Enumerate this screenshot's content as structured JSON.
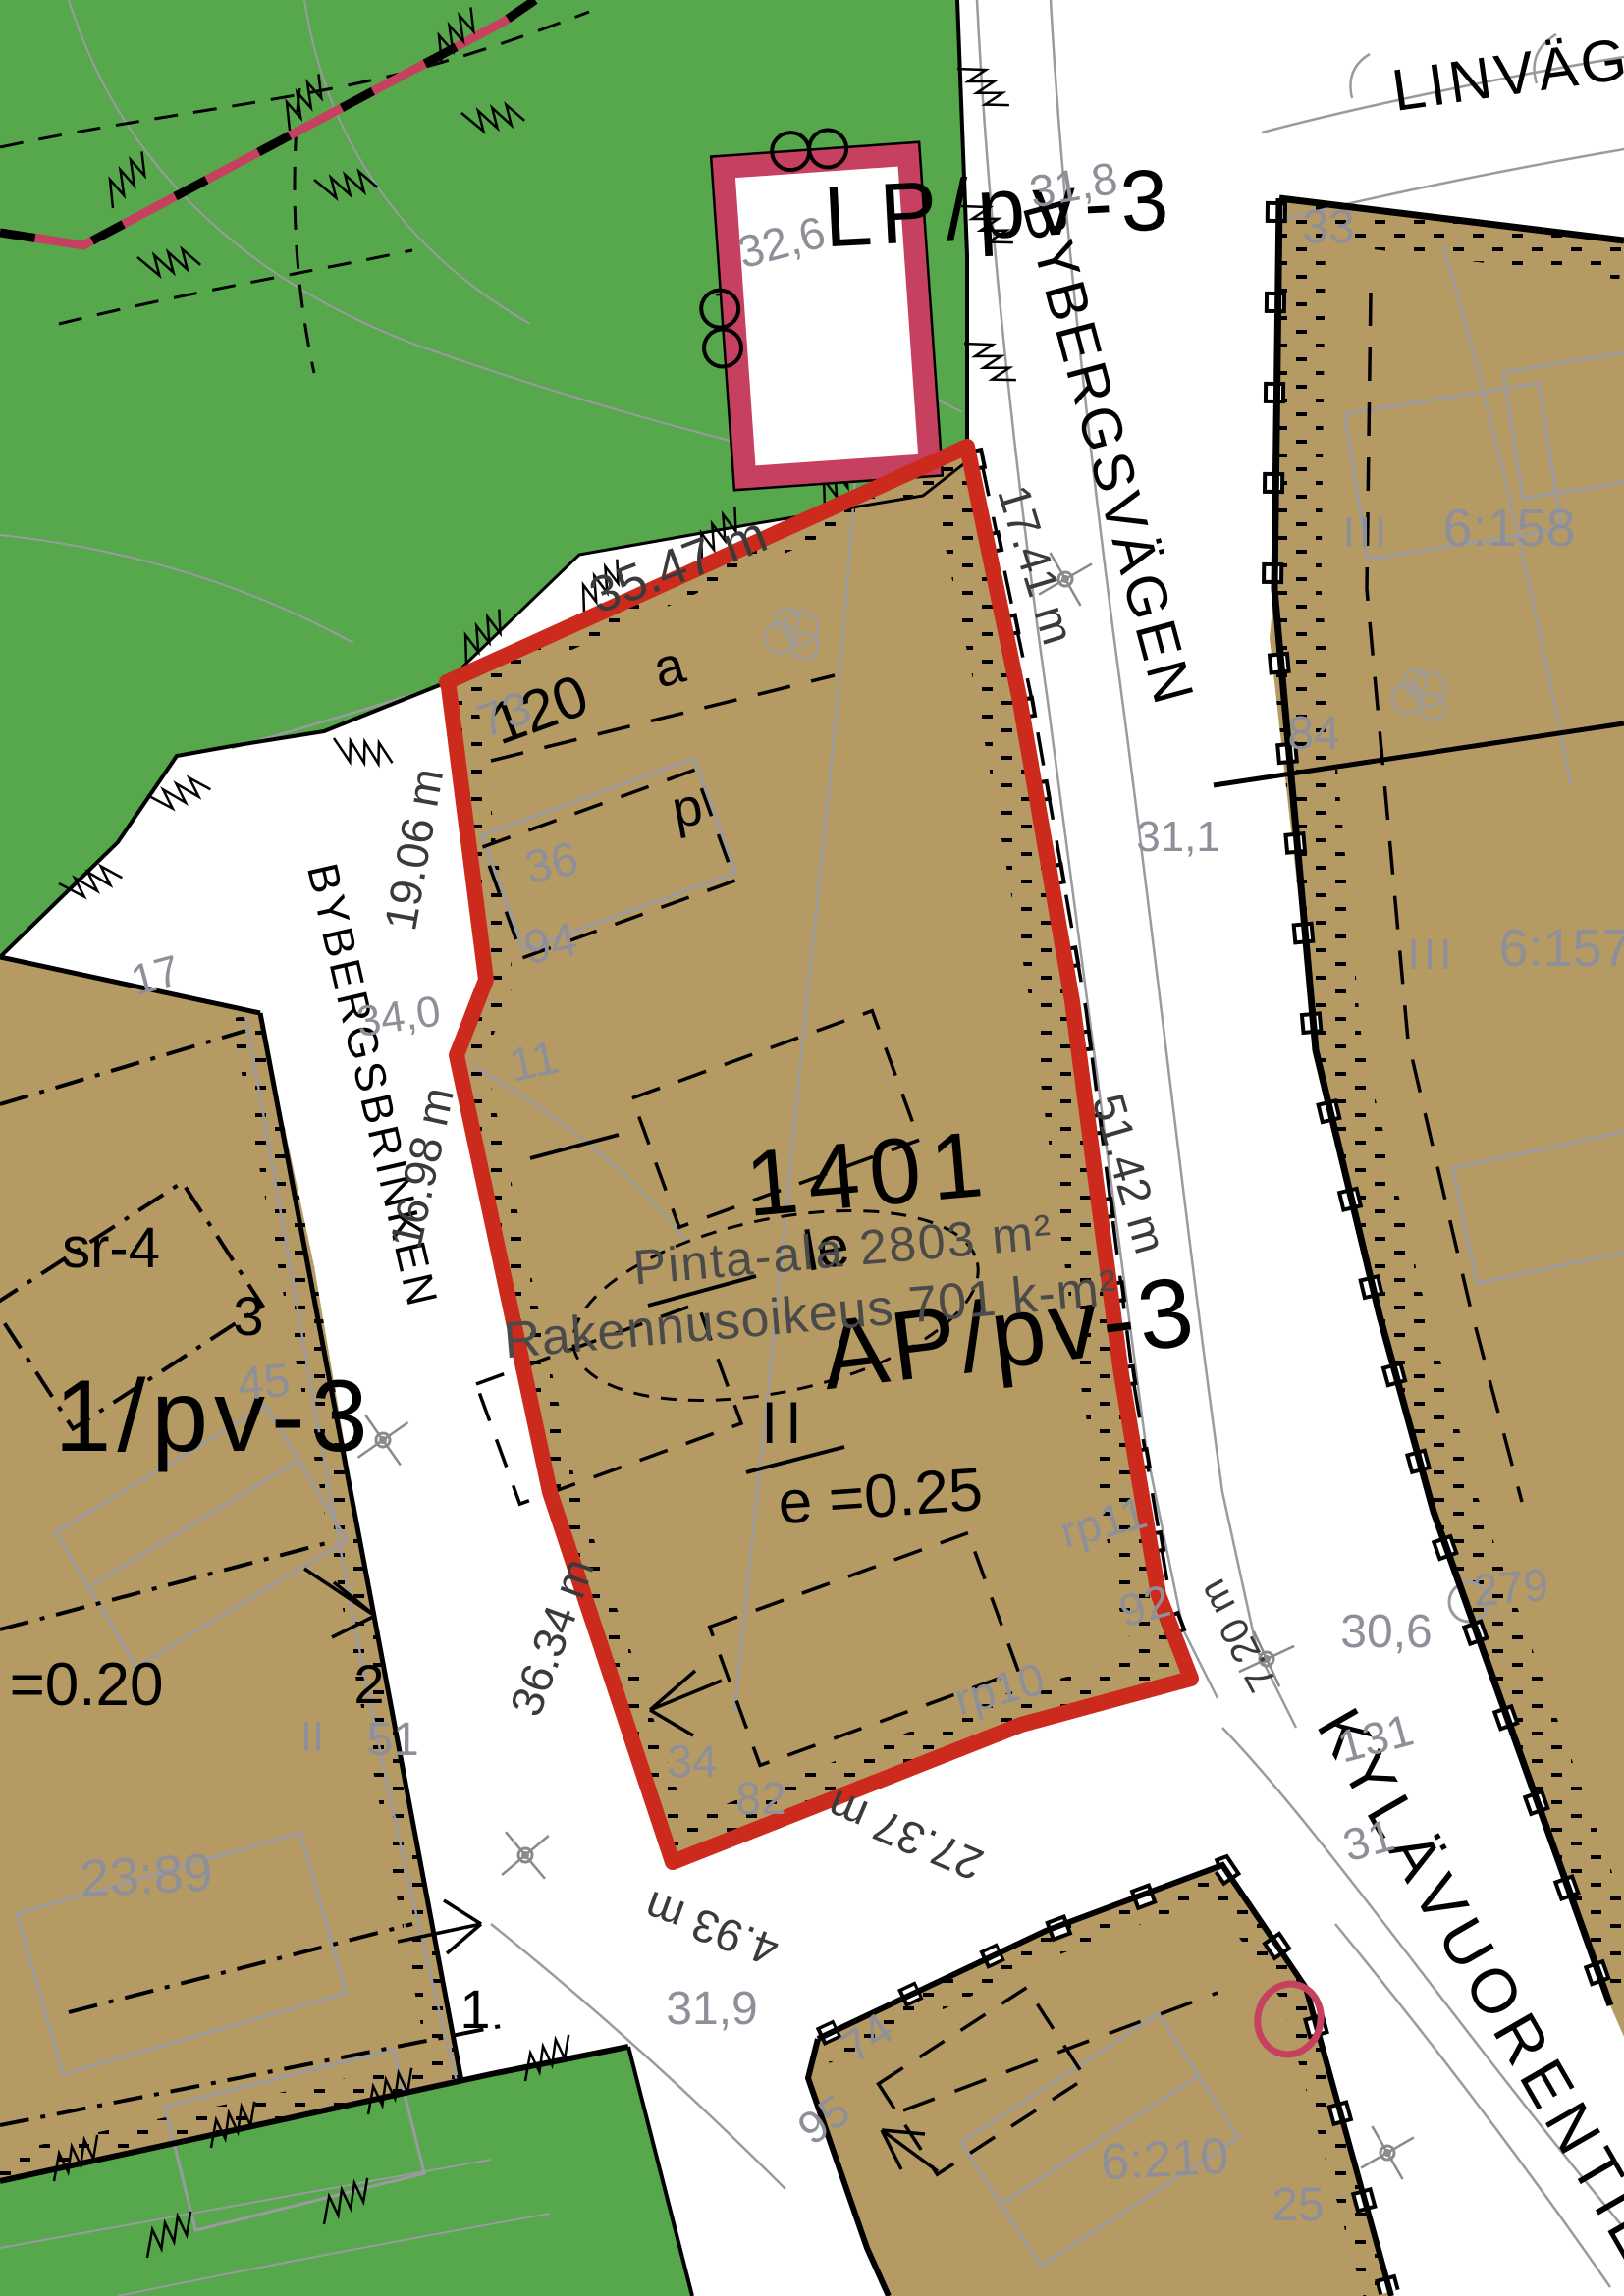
{
  "colors": {
    "forest_green": "#57A84C",
    "parcel_tan": "#B59B63",
    "boundary_red": "#CC2A1C",
    "plan_pink": "#C6415F",
    "label_gray": "#8F8F99",
    "dimension_gray": "#3A3A3A"
  },
  "streets": {
    "bybergsvagen": "BYBERGSVÄGEN",
    "bybergsbrinken": "BYBERGSBRINKEN",
    "kylavuorentie": "KYLÄVUORENTIE",
    "linvagen": "LINVÄG"
  },
  "zones": {
    "lp_code": "LP/pv-3",
    "ap_code": "AP/pv-3",
    "left_code": "1/pv-3",
    "efficiency_ap": "e =0.25",
    "efficiency_left": "=0.20",
    "floors_ap": "II",
    "protection": "sr-4",
    "play_area": "le"
  },
  "plot": {
    "number": "1401",
    "area_text": "Pinta-ala 2803 m²",
    "building_right_text": "Rakennusoikeus 701 k-m²"
  },
  "dimensions": {
    "top": "35.47 m",
    "northeast": "17.41 m",
    "west_upper": "19.06 m",
    "west_mid": "34,0",
    "west_lower": "16.98 m",
    "southwest": "36.34 m",
    "east": "51.42 m",
    "south": "27.37 m",
    "south_corner": "4.93 m",
    "southeast": "7.20 m"
  },
  "labels": {
    "n32_6": "32,6",
    "n31_8": "31,8",
    "n33": "33",
    "n6_158": "6:158",
    "niii_a": "III",
    "n84": "84",
    "n31_1": "31,1",
    "n6_157": "6:157",
    "niii_b": "III",
    "n73": "73",
    "n120": "120",
    "na": "a",
    "np": "p",
    "n36": "36",
    "n94": "94",
    "n11": "11",
    "n17": "17",
    "n45": "45",
    "n3": "3",
    "n2": "2",
    "n1": "1",
    "nii": "II",
    "n51": "51",
    "n23_89": "23:89",
    "nrp11": "rp11",
    "n92": "92",
    "nrp10": "rp10",
    "n34": "34",
    "n82": "82",
    "n31_9": "31,9",
    "n74": "74",
    "n95": "95",
    "n279": "279",
    "n30_6": "30,6",
    "n131": "131",
    "n31": "31",
    "n6_210": "6:210",
    "n25": "25"
  }
}
